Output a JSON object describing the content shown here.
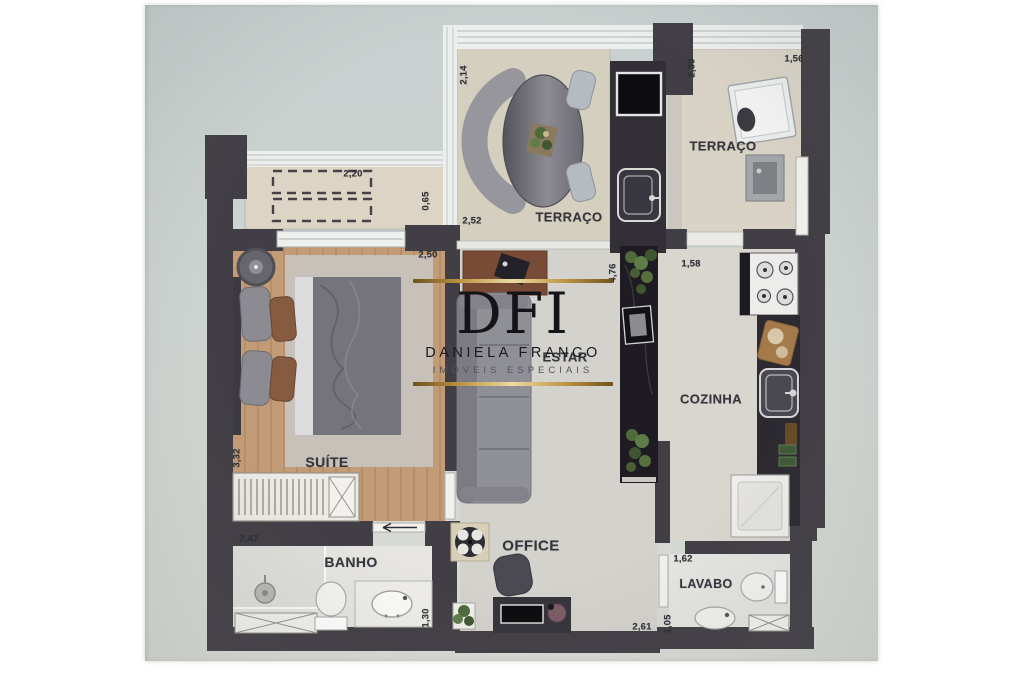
{
  "brand": {
    "monogram": "DFI",
    "name": "DANIELA FRANCO",
    "tagline": "IMÓVEIS ESPECIAIS",
    "gold": "#b98f3e"
  },
  "plan": {
    "wall_color": "#423e45",
    "rooms": {
      "terrace_main": {
        "label": "TERRAÇO",
        "dim_v": "2,14",
        "dim_h": "2,52"
      },
      "terrace_service": {
        "label": "TERRAÇO",
        "dim_v": "2,39",
        "dim_h": "1,56"
      },
      "ac_ledge": {
        "dim_h": "2,20",
        "dim_v": "0,65"
      },
      "suite": {
        "label": "SUÍTE",
        "dim_h": "2,50",
        "dim_v": "3,32"
      },
      "living": {
        "label": "ESTAR",
        "dim_v": "4,76"
      },
      "kitchen": {
        "label": "COZINHA",
        "dim_h": "1,58"
      },
      "bathroom": {
        "label": "BANHO",
        "dim_h": "2,47",
        "dim_v": "1,30"
      },
      "office": {
        "label": "OFFICE",
        "dim_h": "2,61"
      },
      "lavatory": {
        "label": "LAVABO",
        "dim_h": "1,62",
        "dim_v": "1,05"
      }
    }
  }
}
